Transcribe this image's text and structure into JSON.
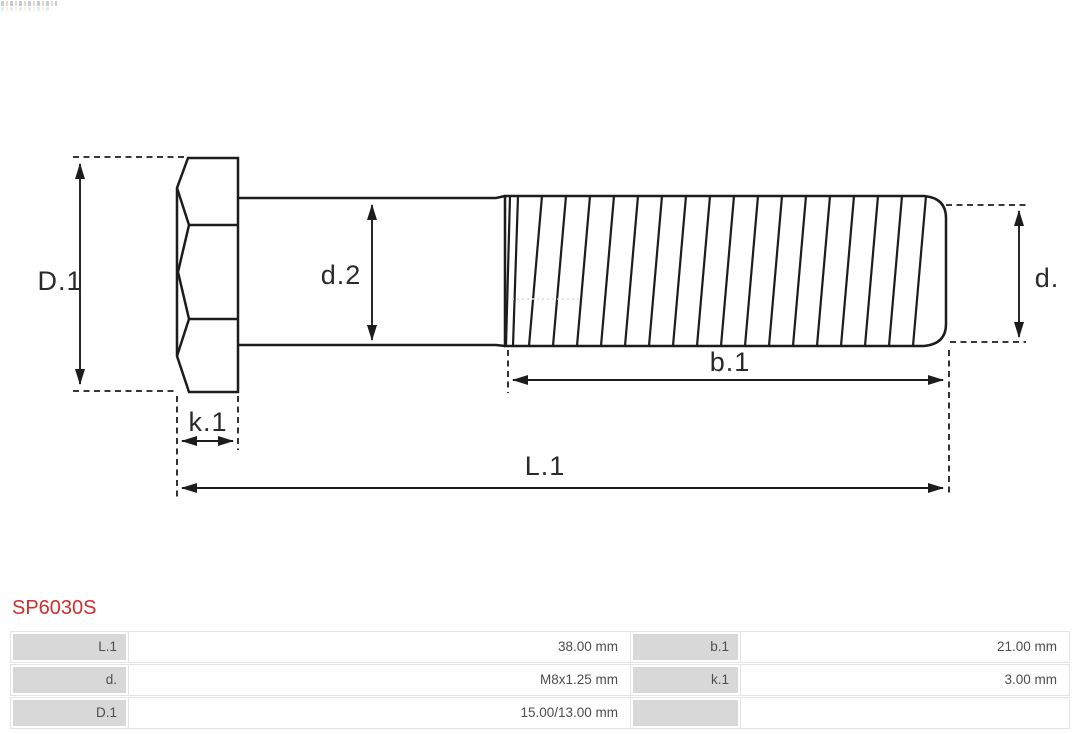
{
  "theme": {
    "accent_red": "#cf2e2e",
    "line_color": "#1c1c1c",
    "label_color": "#2a2a2a",
    "table_text": "#4d4d4d",
    "table_label_bg": "#d8d8d8",
    "table_border": "#e4e4e4"
  },
  "part_number": "SP6030S",
  "diagram": {
    "labels": {
      "head_diameter": "D.1",
      "shank_diameter": "d.2",
      "thread_diameter": "d.",
      "thread_length": "b.1",
      "head_height": "k.1",
      "total_length": "L.1"
    }
  },
  "table": {
    "rows": [
      {
        "label1": "L.1",
        "value1": "38.00 mm",
        "label2": "b.1",
        "value2": "21.00 mm"
      },
      {
        "label1": "d.",
        "value1": "M8x1.25 mm",
        "label2": "k.1",
        "value2": "3.00 mm"
      },
      {
        "label1": "D.1",
        "value1": "15.00/13.00 mm",
        "label2": "",
        "value2": ""
      }
    ]
  }
}
